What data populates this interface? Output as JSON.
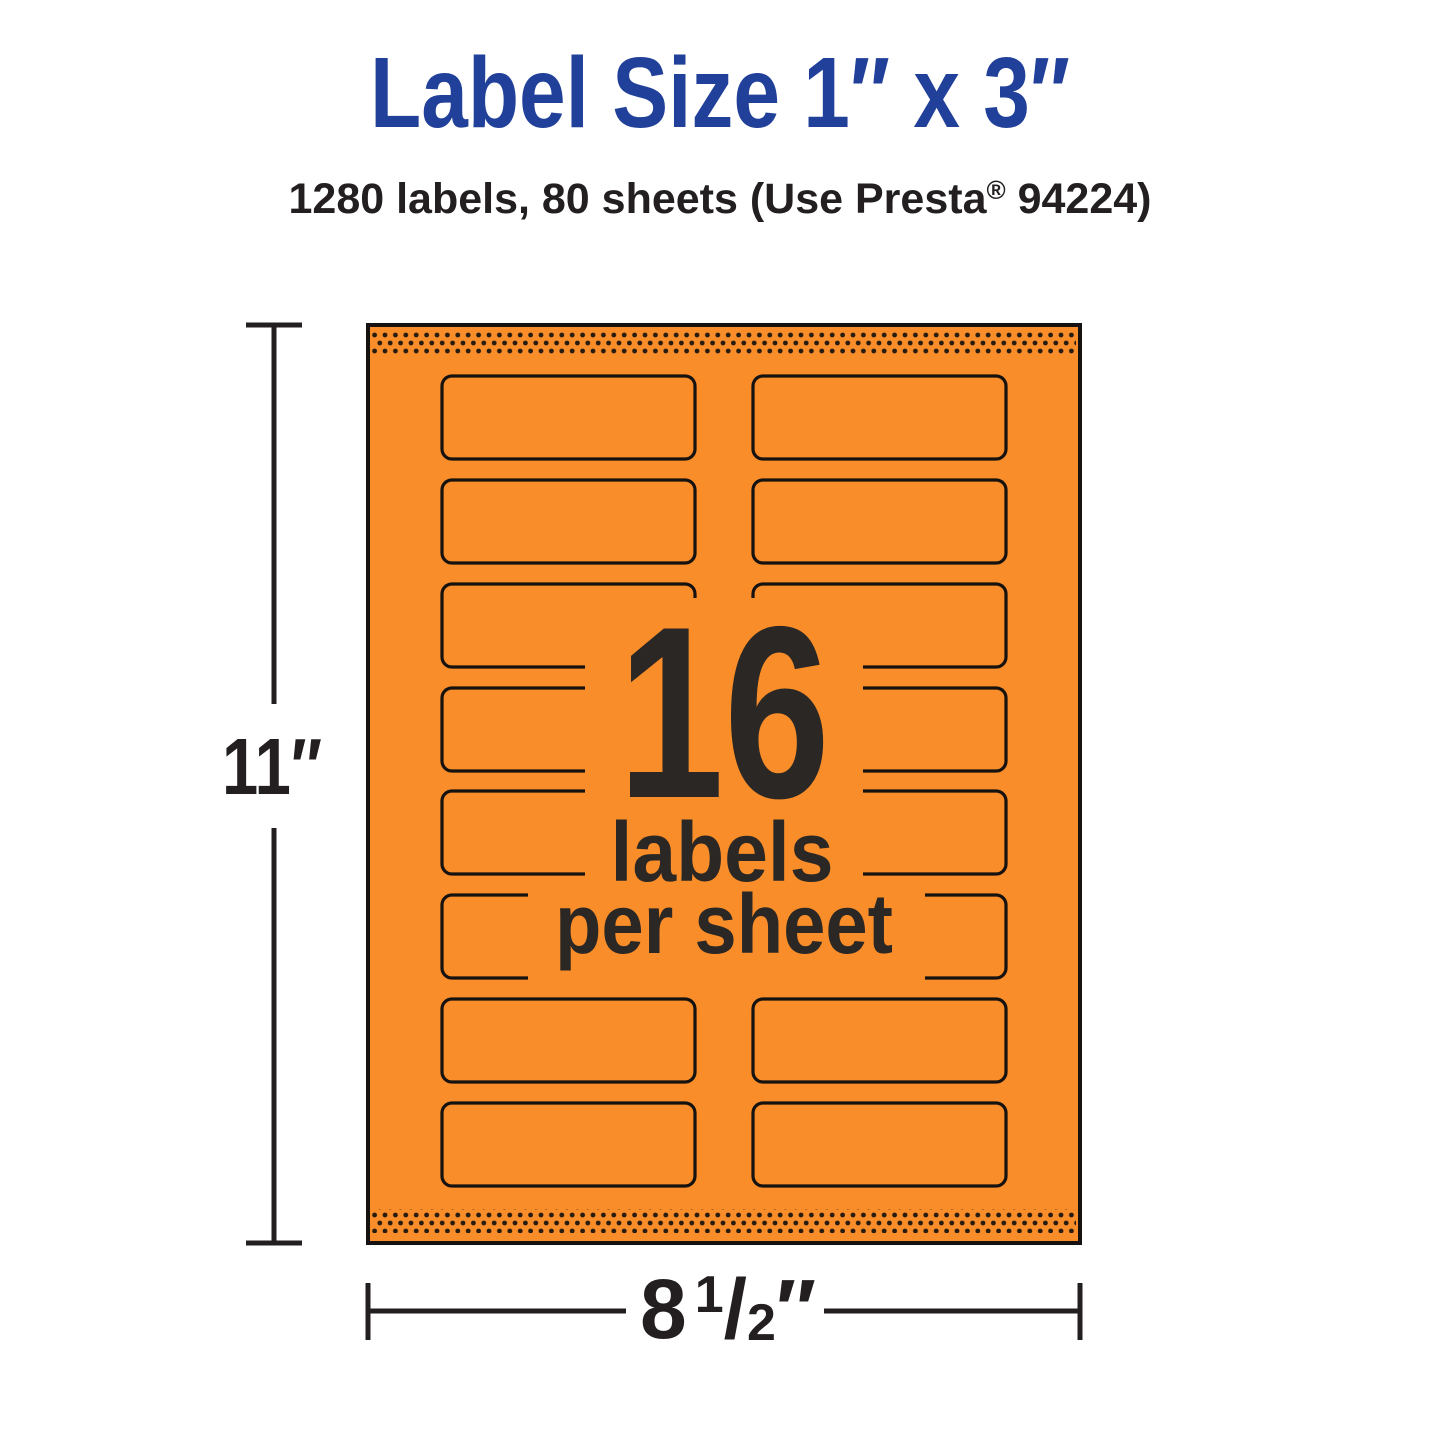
{
  "header": {
    "title": "Label Size 1″ x 3″",
    "subtitle_before_reg": "1280 labels, 80 sheets (Use Presta",
    "subtitle_reg": "®",
    "subtitle_after_reg": " 94224)"
  },
  "sheet": {
    "count": "16",
    "caption_line1": "labels",
    "caption_line2": "per sheet",
    "rows": 8,
    "columns": 2,
    "total_labels": 16
  },
  "dimensions": {
    "height": "11″",
    "width_whole": "8",
    "width_numerator": "1",
    "width_slash": "/",
    "width_denominator": "2",
    "width_unit": "″"
  },
  "colors": {
    "background": "#FFFFFF",
    "sheet_orange": "#F98D29",
    "title_blue": "#21409A",
    "ink_dark": "#2B2724",
    "dim_ink": "#231F20",
    "outline_black": "#161210",
    "dot_brown": "#281B0F"
  }
}
